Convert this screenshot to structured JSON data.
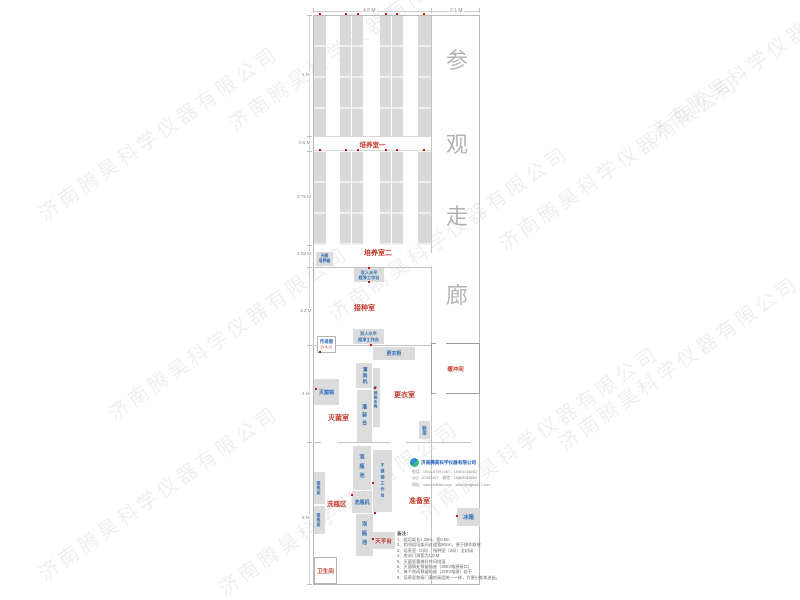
{
  "dims": {
    "top": [
      "4.8 M",
      "2.1 M"
    ],
    "left": [
      "5 M",
      "0.6 M",
      "3.75 M",
      "1.05 M",
      "3.2 M",
      "4 M",
      "6 M"
    ]
  },
  "corridor": {
    "name": "参观走廊",
    "chars": [
      "参",
      "观",
      "走",
      "廊"
    ]
  },
  "rooms": {
    "culture1": "培养室一",
    "culture2": "培养室二",
    "inoculation": "接种室",
    "sterilize": "灭菌室",
    "changing": "更衣室",
    "buffer": "缓冲间",
    "prep": "准备室",
    "washing": "洗瓶区",
    "toilet": "卫生间"
  },
  "equipment": {
    "light_incubator": "光照\n培养箱",
    "clean_bench": "双人水平\n超净工作台",
    "pass_window": "传递窗",
    "pass_window_size": "(0.6㎡)",
    "locker": "更衣柜",
    "autoclave": "灭菌锅",
    "filler": "灌装机",
    "steel_bench": "不锈钢条凳",
    "filling_table": "灌装台",
    "shoe_rack": "鞋架",
    "soak_pool": "泡瓶池",
    "steel_table": "不锈钢工作台",
    "bottle_washer": "洗瓶机",
    "dry_rack": "晾瓶架",
    "balance": "天平台",
    "fridge": "冰箱"
  },
  "logo": {
    "company": "济南腾昊科学仪器有限公司",
    "contact_lines": [
      "电话：0531-87937467，15064015052",
      "QQ：87437467　微信：15864015052",
      "网址：www.sdthkx.com　www.tenghao17.com"
    ]
  },
  "notes": {
    "title": "备注：",
    "items": [
      "1、组培架长1.25m，宽0.5m",
      "2、相邻组培架间过道宽80cm，便于操作取放",
      "3、培养室（3间）、接种室（2间）全封闭",
      "4、房间门洞宽为1.0 M",
      "5、灭菌室要做好排风排湿",
      "6、灭菌锅处预留插座（380V电源接口）",
      "7、每个房间预留插座（220V电源）若干",
      "8、培养室和接门洞的高度统一一样，方便小推车进出。"
    ]
  },
  "watermark": {
    "text": "济南腾昊科学仪器有限公司"
  },
  "colors": {
    "room_label": "#c0392b",
    "equipment_label": "#2e6db4",
    "rack_fill": "#d9d9d9",
    "wall": "#c3c3c3",
    "outlet_dot": "#cc1111"
  }
}
